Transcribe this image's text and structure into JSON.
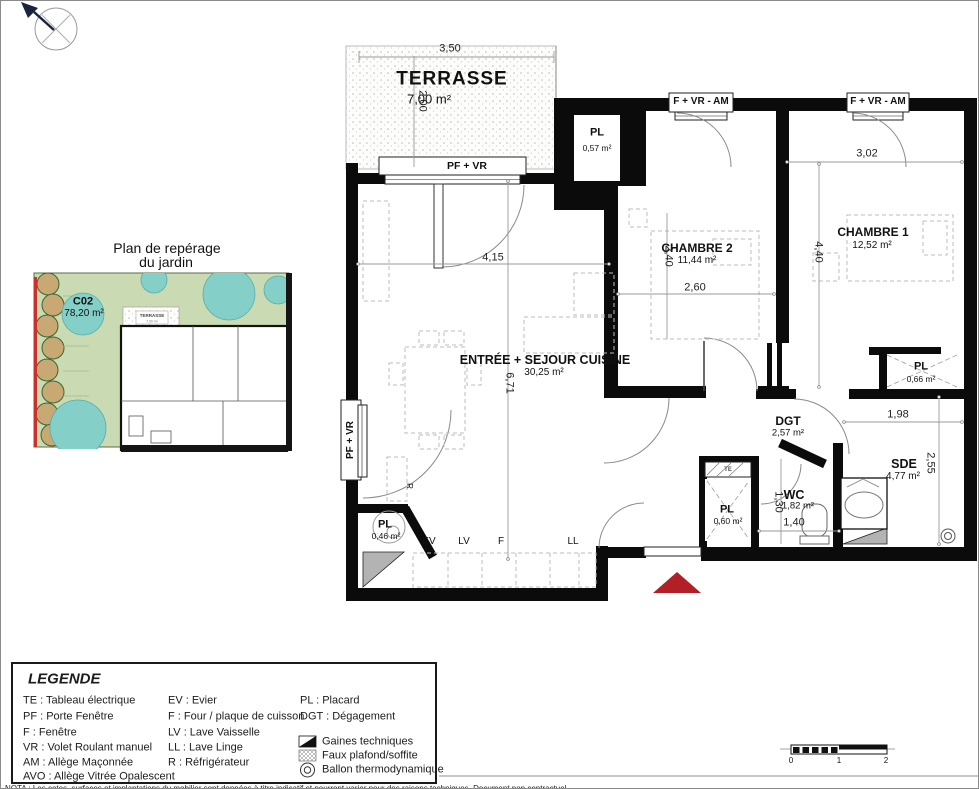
{
  "plan": {
    "terrasse": {
      "name": "TERRASSE",
      "area": "7,00 m²"
    },
    "sejour": {
      "name": "ENTRÉE + SEJOUR CUISINE",
      "area": "30,25 m²"
    },
    "chambre1": {
      "name": "CHAMBRE 1",
      "area": "12,52 m²"
    },
    "chambre2": {
      "name": "CHAMBRE 2",
      "area": "11,44 m²"
    },
    "dgt": {
      "name": "DGT",
      "area": "2,57 m²"
    },
    "wc": {
      "name": "WC",
      "area": "1,82 m²"
    },
    "sde": {
      "name": "SDE",
      "area": "4,77 m²"
    },
    "pl_entree": {
      "name": "PL",
      "area": "0,57 m²"
    },
    "pl_chambre": {
      "name": "PL",
      "area": "0,66 m²"
    },
    "pl_hall": {
      "name": "PL",
      "area": "0,60 m²"
    },
    "pl_cuisine": {
      "name": "PL",
      "area": "0,46 m²"
    }
  },
  "dims": {
    "d350": "3,50",
    "d200": "2,00",
    "d415": "4,15",
    "d671": "6,71",
    "d260": "2,60",
    "d240": "2,40",
    "d302": "3,02",
    "d440": "4,40",
    "d198": "1,98",
    "d255": "2,55",
    "d130": "1,30",
    "d140": "1,40"
  },
  "openings": {
    "pf_vr": "PF + VR",
    "f_vr_am": "F + VR - AM"
  },
  "equip": {
    "te": "TE",
    "r": "R",
    "ev": "EV",
    "lv": "LV",
    "f": "F",
    "ll": "LL"
  },
  "minimap": {
    "title1": "Plan de repérage",
    "title2": "du jardin",
    "lot": "C02",
    "lot_area": "78,20 m²",
    "terrasse": "TERRASSE",
    "terrasse_area": "7,00 m²"
  },
  "legend": {
    "title": "LEGENDE",
    "col1": [
      "TE :  Tableau électrique",
      "PF :  Porte Fenêtre",
      "F :  Fenêtre",
      "VR : Volet Roulant manuel",
      "AM : Allège Maçonnée",
      "AVO :  Allège Vitrée Opalescent"
    ],
    "col2": [
      "EV :  Evier",
      "F :  Four / plaque de cuisson",
      "LV :  Lave Vaisselle",
      "LL :  Lave Linge",
      "R :  Réfrigérateur"
    ],
    "col3": [
      "PL :  Placard",
      "DGT : Dégagement"
    ],
    "symbols": [
      "Gaines techniques",
      "Faux plafond/soffite",
      "Ballon thermodynamique"
    ]
  },
  "scalebar": {
    "t0": "0",
    "t1": "1",
    "t2": "2"
  },
  "note": "NOTA : Les cotes, surfaces et implantations du mobilier sont données à titre indicatif et pourront varier pour des raisons techniques. Document non contractuel."
}
